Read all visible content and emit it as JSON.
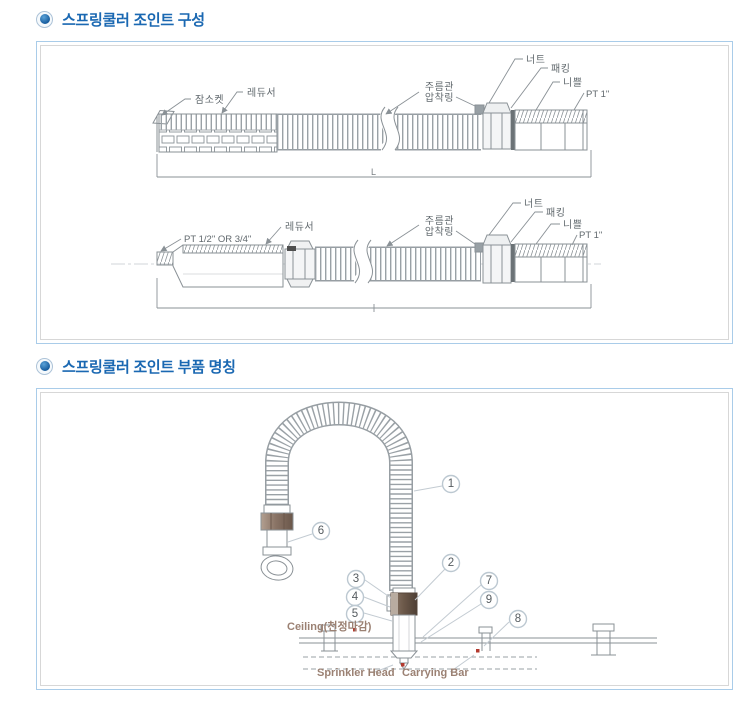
{
  "sections": [
    {
      "title": "스프링쿨러 조인트 구성"
    },
    {
      "title": "스프링쿨러 조인트 부품 명칭"
    }
  ],
  "joint_composition": {
    "top_diagram": {
      "socket": "잠소켓",
      "reducer": "레듀서",
      "ring_line1": "주름관",
      "ring_line2": "압착링",
      "nut": "너트",
      "packing": "패킹",
      "nipple": "니쁠",
      "pt": "PT 1\"",
      "dim": "L"
    },
    "bottom_diagram": {
      "pt_left": "PT 1/2\" OR 3/4\"",
      "reducer": "레듀서",
      "ring_line1": "주름관",
      "ring_line2": "압착링",
      "nut": "너트",
      "packing": "패킹",
      "nipple": "니쁠",
      "pt": "PT 1\""
    }
  },
  "parts_diagram": {
    "callouts": [
      "1",
      "2",
      "3",
      "4",
      "5",
      "6",
      "7",
      "8",
      "9"
    ],
    "labels": {
      "ceiling": "Ceiling(천정마감)",
      "sprinkler_head": "Sprinkler Head",
      "carrying_bar": "Carrying Bar"
    }
  },
  "colors": {
    "title_blue": "#1a68b2",
    "panel_border": "#a9cce9",
    "inner_border": "#d7d7d7",
    "line_gray": "#8a9196",
    "label_gray": "#60686d",
    "brown_label": "#9b8173",
    "callout_ring": "#bcc8d1",
    "red_marker": "#b33a2f",
    "nut_brown": "#8a7466"
  }
}
